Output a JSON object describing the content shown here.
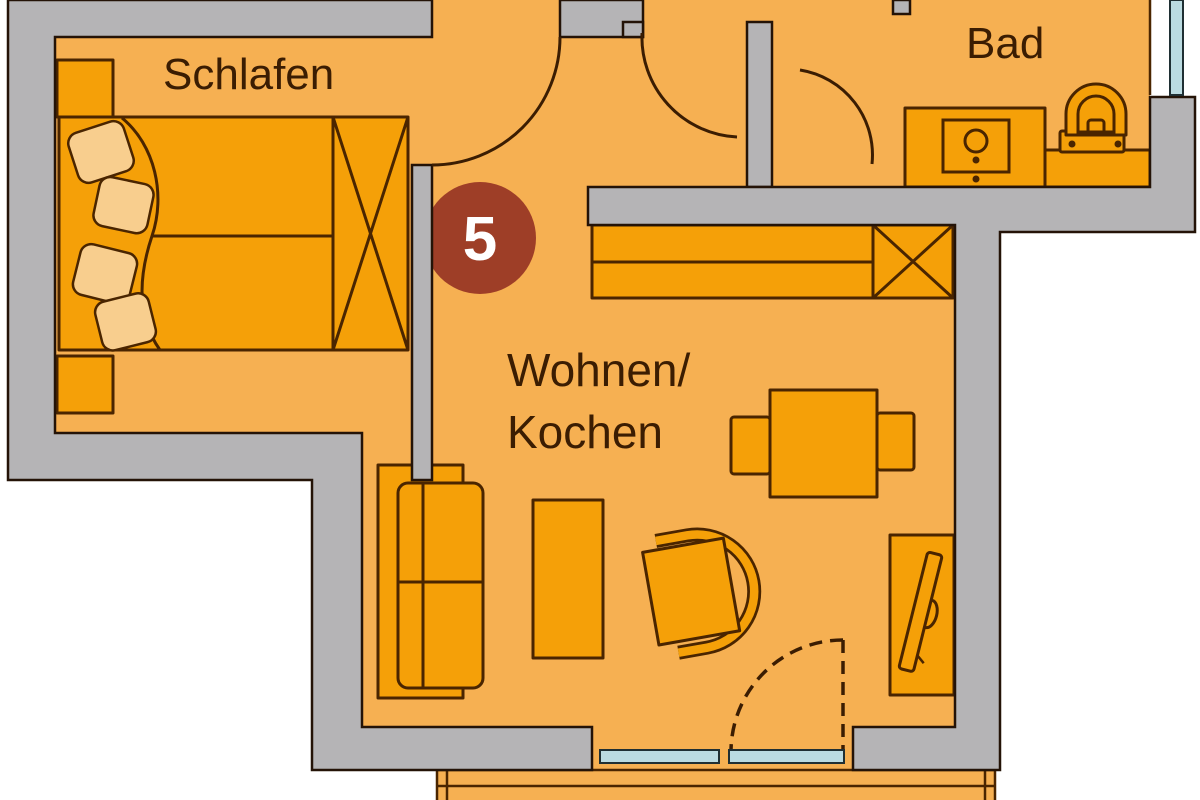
{
  "title": "Apartment floor plan, unit 5",
  "unit_badge": {
    "number": "5"
  },
  "rooms": {
    "bedroom": {
      "label": "Schlafen"
    },
    "bathroom": {
      "label": "Bad"
    },
    "living": {
      "label_line1": "Wohnen/",
      "label_line2": "Kochen"
    }
  },
  "colors": {
    "floor": "#F6B052",
    "furniture": "#F5A008",
    "pillow": "#F8CE8E",
    "wall": "#B5B4B6",
    "outline": "#4A2500",
    "wall_outline": "#241307",
    "text": "#3B1D02",
    "badge": "#9E3E27",
    "badge_text": "#FFFFFF",
    "glass": "#BBDBE1",
    "outside": "#FFFFFF"
  },
  "icons": {
    "bed": "double-bed-icon",
    "pillows": "pillow-icon",
    "wardrobe": "wardrobe-x-icon",
    "nightstand": "nightstand-icon",
    "kitchen_counter": "kitchen-counter-icon",
    "tall_cabinet": "tall-cabinet-x-icon",
    "vanity": "washbasin-cabinet-icon",
    "toilet": "toilet-icon",
    "sofa": "sofa-icon",
    "coffee_table": "coffee-table-icon",
    "armchair": "armchair-icon",
    "dining_table": "dining-table-icon",
    "dining_chair": "dining-chair-icon",
    "sideboard": "sideboard-icon",
    "tv": "tv-icon",
    "door_swing": "door-swing-arc-icon",
    "window": "window-glass-icon",
    "balcony": "balcony-icon"
  }
}
